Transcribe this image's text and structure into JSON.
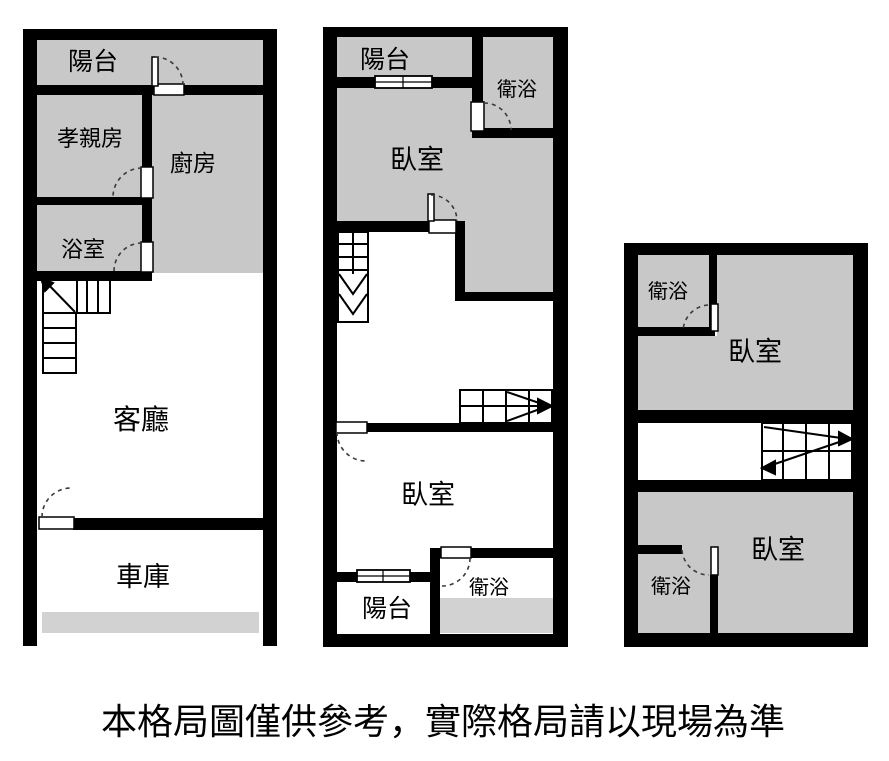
{
  "caption": "本格局圖僅供參考，實際格局請以現場為準",
  "colors": {
    "wall": "#000000",
    "room_fill": "#c8c8c8",
    "strip_fill": "#d2d2d2",
    "background": "#ffffff",
    "door_arc": "#3a3a3a"
  },
  "floor1": {
    "balcony": "陽台",
    "parents_room": "孝親房",
    "kitchen": "廚房",
    "bathroom": "浴室",
    "living_room": "客廳",
    "garage": "車庫"
  },
  "floor2": {
    "balcony_front": "陽台",
    "bathroom_front": "衛浴",
    "bedroom_front": "臥室",
    "bedroom_rear": "臥室",
    "balcony_rear": "陽台",
    "bathroom_rear": "衛浴"
  },
  "floor3": {
    "bathroom_upper": "衛浴",
    "bedroom_upper": "臥室",
    "bedroom_lower": "臥室",
    "bathroom_lower": "衛浴"
  }
}
